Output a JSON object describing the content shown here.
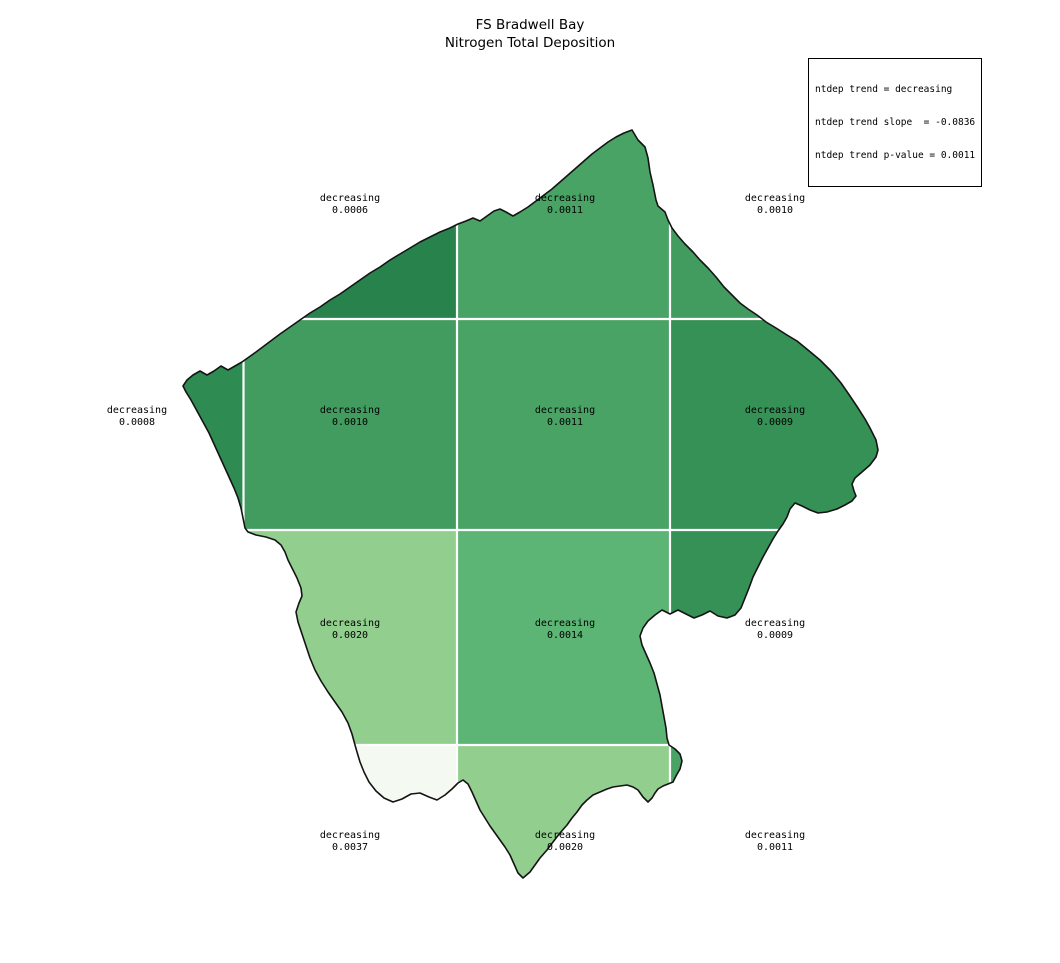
{
  "title": {
    "line1": "FS Bradwell Bay",
    "line2": "Nitrogen Total Deposition"
  },
  "stats_box": {
    "line1": "ntdep trend = decreasing",
    "line2": "ntdep trend slope  = -0.0836",
    "line3": "ntdep trend p-value = 0.0011"
  },
  "map": {
    "outline_color": "#141414",
    "gridline_color": "#ffffff",
    "background": "#ffffff",
    "col_edges": [
      150,
      243.5,
      457,
      670,
      895
    ],
    "row_edges": [
      112,
      319,
      530,
      745,
      895
    ],
    "cells": [
      {
        "row": 0,
        "col": 1,
        "trend": "decreasing",
        "value": "0.0006",
        "color": "#28824C",
        "label_x": 350,
        "label_y": 205
      },
      {
        "row": 0,
        "col": 2,
        "trend": "decreasing",
        "value": "0.0011",
        "color": "#48A365",
        "label_x": 565,
        "label_y": 205
      },
      {
        "row": 0,
        "col": 3,
        "trend": "decreasing",
        "value": "0.0010",
        "color": "#429C60",
        "label_x": 775,
        "label_y": 205
      },
      {
        "row": 1,
        "col": 0,
        "trend": "decreasing",
        "value": "0.0008",
        "color": "#2E8B52",
        "label_x": 137,
        "label_y": 417
      },
      {
        "row": 1,
        "col": 1,
        "trend": "decreasing",
        "value": "0.0010",
        "color": "#429C60",
        "label_x": 350,
        "label_y": 417
      },
      {
        "row": 1,
        "col": 2,
        "trend": "decreasing",
        "value": "0.0011",
        "color": "#48A365",
        "label_x": 565,
        "label_y": 417
      },
      {
        "row": 1,
        "col": 3,
        "trend": "decreasing",
        "value": "0.0009",
        "color": "#359155",
        "label_x": 775,
        "label_y": 417
      },
      {
        "row": 2,
        "col": 1,
        "trend": "decreasing",
        "value": "0.0020",
        "color": "#92CF8E",
        "label_x": 350,
        "label_y": 630
      },
      {
        "row": 2,
        "col": 2,
        "trend": "decreasing",
        "value": "0.0014",
        "color": "#5CB574",
        "label_x": 565,
        "label_y": 630
      },
      {
        "row": 2,
        "col": 3,
        "trend": "decreasing",
        "value": "0.0009",
        "color": "#359155",
        "label_x": 775,
        "label_y": 630
      },
      {
        "row": 3,
        "col": 1,
        "trend": "decreasing",
        "value": "0.0037",
        "color": "#F4FAF1",
        "label_x": 350,
        "label_y": 842
      },
      {
        "row": 3,
        "col": 2,
        "trend": "decreasing",
        "value": "0.0020",
        "color": "#92CF8E",
        "label_x": 565,
        "label_y": 842
      },
      {
        "row": 3,
        "col": 3,
        "trend": "decreasing",
        "value": "0.0011",
        "color": "#48A365",
        "label_x": 775,
        "label_y": 842
      }
    ],
    "outline_points": [
      [
        632,
        130
      ],
      [
        638,
        140
      ],
      [
        645,
        147
      ],
      [
        648,
        158
      ],
      [
        650,
        172
      ],
      [
        653,
        185
      ],
      [
        656,
        200
      ],
      [
        658,
        206
      ],
      [
        665,
        212
      ],
      [
        668,
        220
      ],
      [
        672,
        228
      ],
      [
        678,
        236
      ],
      [
        685,
        244
      ],
      [
        693,
        252
      ],
      [
        700,
        260
      ],
      [
        708,
        268
      ],
      [
        716,
        277
      ],
      [
        724,
        287
      ],
      [
        732,
        295
      ],
      [
        740,
        303
      ],
      [
        748,
        309
      ],
      [
        757,
        315
      ],
      [
        766,
        322
      ],
      [
        776,
        328
      ],
      [
        787,
        335
      ],
      [
        797,
        341
      ],
      [
        808,
        350
      ],
      [
        820,
        360
      ],
      [
        831,
        371
      ],
      [
        841,
        383
      ],
      [
        850,
        396
      ],
      [
        858,
        408
      ],
      [
        865,
        419
      ],
      [
        870,
        428
      ],
      [
        876,
        440
      ],
      [
        878,
        450
      ],
      [
        876,
        457
      ],
      [
        870,
        465
      ],
      [
        862,
        472
      ],
      [
        855,
        478
      ],
      [
        852,
        484
      ],
      [
        854,
        491
      ],
      [
        856,
        496
      ],
      [
        852,
        501
      ],
      [
        845,
        505
      ],
      [
        837,
        509
      ],
      [
        827,
        512
      ],
      [
        818,
        513
      ],
      [
        810,
        510
      ],
      [
        802,
        506
      ],
      [
        795,
        503
      ],
      [
        790,
        509
      ],
      [
        787,
        517
      ],
      [
        783,
        524
      ],
      [
        778,
        531
      ],
      [
        773,
        539
      ],
      [
        768,
        548
      ],
      [
        763,
        557
      ],
      [
        758,
        567
      ],
      [
        753,
        577
      ],
      [
        749,
        588
      ],
      [
        745,
        598
      ],
      [
        741,
        608
      ],
      [
        735,
        615
      ],
      [
        727,
        618
      ],
      [
        718,
        616
      ],
      [
        710,
        611
      ],
      [
        702,
        615
      ],
      [
        694,
        618
      ],
      [
        686,
        614
      ],
      [
        678,
        610
      ],
      [
        670,
        614
      ],
      [
        662,
        610
      ],
      [
        655,
        615
      ],
      [
        648,
        621
      ],
      [
        643,
        628
      ],
      [
        640,
        636
      ],
      [
        642,
        645
      ],
      [
        646,
        654
      ],
      [
        650,
        663
      ],
      [
        654,
        673
      ],
      [
        657,
        684
      ],
      [
        660,
        695
      ],
      [
        662,
        706
      ],
      [
        664,
        717
      ],
      [
        666,
        728
      ],
      [
        667,
        738
      ],
      [
        669,
        745
      ],
      [
        675,
        749
      ],
      [
        680,
        754
      ],
      [
        682,
        761
      ],
      [
        680,
        769
      ],
      [
        676,
        776
      ],
      [
        673,
        782
      ],
      [
        668,
        784
      ],
      [
        663,
        786
      ],
      [
        658,
        789
      ],
      [
        655,
        793
      ],
      [
        652,
        798
      ],
      [
        648,
        802
      ],
      [
        643,
        797
      ],
      [
        638,
        790
      ],
      [
        633,
        787
      ],
      [
        627,
        785
      ],
      [
        620,
        786
      ],
      [
        613,
        787
      ],
      [
        607,
        789
      ],
      [
        600,
        792
      ],
      [
        593,
        795
      ],
      [
        587,
        800
      ],
      [
        582,
        805
      ],
      [
        577,
        812
      ],
      [
        572,
        818
      ],
      [
        567,
        825
      ],
      [
        560,
        833
      ],
      [
        553,
        842
      ],
      [
        547,
        850
      ],
      [
        540,
        858
      ],
      [
        535,
        865
      ],
      [
        530,
        872
      ],
      [
        523,
        878
      ],
      [
        518,
        873
      ],
      [
        514,
        864
      ],
      [
        510,
        855
      ],
      [
        505,
        847
      ],
      [
        500,
        840
      ],
      [
        495,
        833
      ],
      [
        490,
        826
      ],
      [
        485,
        818
      ],
      [
        480,
        810
      ],
      [
        476,
        801
      ],
      [
        472,
        792
      ],
      [
        468,
        784
      ],
      [
        463,
        780
      ],
      [
        458,
        783
      ],
      [
        452,
        789
      ],
      [
        445,
        795
      ],
      [
        437,
        800
      ],
      [
        429,
        797
      ],
      [
        420,
        793
      ],
      [
        411,
        794
      ],
      [
        402,
        799
      ],
      [
        393,
        802
      ],
      [
        384,
        798
      ],
      [
        376,
        791
      ],
      [
        369,
        782
      ],
      [
        364,
        772
      ],
      [
        360,
        762
      ],
      [
        357,
        752
      ],
      [
        355,
        745
      ],
      [
        352,
        734
      ],
      [
        348,
        723
      ],
      [
        342,
        712
      ],
      [
        335,
        702
      ],
      [
        328,
        692
      ],
      [
        321,
        681
      ],
      [
        315,
        670
      ],
      [
        310,
        658
      ],
      [
        306,
        646
      ],
      [
        302,
        634
      ],
      [
        298,
        622
      ],
      [
        296,
        612
      ],
      [
        299,
        603
      ],
      [
        302,
        596
      ],
      [
        301,
        588
      ],
      [
        297,
        578
      ],
      [
        292,
        568
      ],
      [
        288,
        560
      ],
      [
        285,
        552
      ],
      [
        281,
        545
      ],
      [
        275,
        540
      ],
      [
        266,
        537
      ],
      [
        256,
        535
      ],
      [
        248,
        532
      ],
      [
        245,
        528
      ],
      [
        243,
        518
      ],
      [
        241,
        508
      ],
      [
        238,
        498
      ],
      [
        234,
        488
      ],
      [
        229,
        477
      ],
      [
        224,
        466
      ],
      [
        219,
        455
      ],
      [
        214,
        444
      ],
      [
        209,
        433
      ],
      [
        203,
        422
      ],
      [
        197,
        411
      ],
      [
        191,
        400
      ],
      [
        186,
        392
      ],
      [
        183,
        386
      ],
      [
        187,
        380
      ],
      [
        193,
        375
      ],
      [
        200,
        371
      ],
      [
        207,
        375
      ],
      [
        214,
        371
      ],
      [
        221,
        366
      ],
      [
        228,
        370
      ],
      [
        235,
        366
      ],
      [
        242,
        362
      ],
      [
        249,
        357
      ],
      [
        256,
        352
      ],
      [
        264,
        346
      ],
      [
        272,
        340
      ],
      [
        280,
        334
      ],
      [
        290,
        327
      ],
      [
        300,
        320
      ],
      [
        310,
        313
      ],
      [
        320,
        307
      ],
      [
        330,
        300
      ],
      [
        340,
        294
      ],
      [
        350,
        287
      ],
      [
        360,
        280
      ],
      [
        370,
        273
      ],
      [
        380,
        267
      ],
      [
        390,
        260
      ],
      [
        400,
        254
      ],
      [
        410,
        248
      ],
      [
        420,
        242
      ],
      [
        430,
        237
      ],
      [
        440,
        232
      ],
      [
        450,
        228
      ],
      [
        458,
        224
      ],
      [
        466,
        221
      ],
      [
        473,
        218
      ],
      [
        480,
        221
      ],
      [
        487,
        216
      ],
      [
        494,
        211
      ],
      [
        500,
        209
      ],
      [
        506,
        212
      ],
      [
        513,
        216
      ],
      [
        520,
        212
      ],
      [
        528,
        207
      ],
      [
        536,
        201
      ],
      [
        544,
        195
      ],
      [
        552,
        189
      ],
      [
        560,
        182
      ],
      [
        568,
        175
      ],
      [
        576,
        168
      ],
      [
        584,
        161
      ],
      [
        592,
        154
      ],
      [
        600,
        148
      ],
      [
        608,
        142
      ],
      [
        616,
        137
      ],
      [
        624,
        133
      ],
      [
        632,
        130
      ]
    ]
  }
}
